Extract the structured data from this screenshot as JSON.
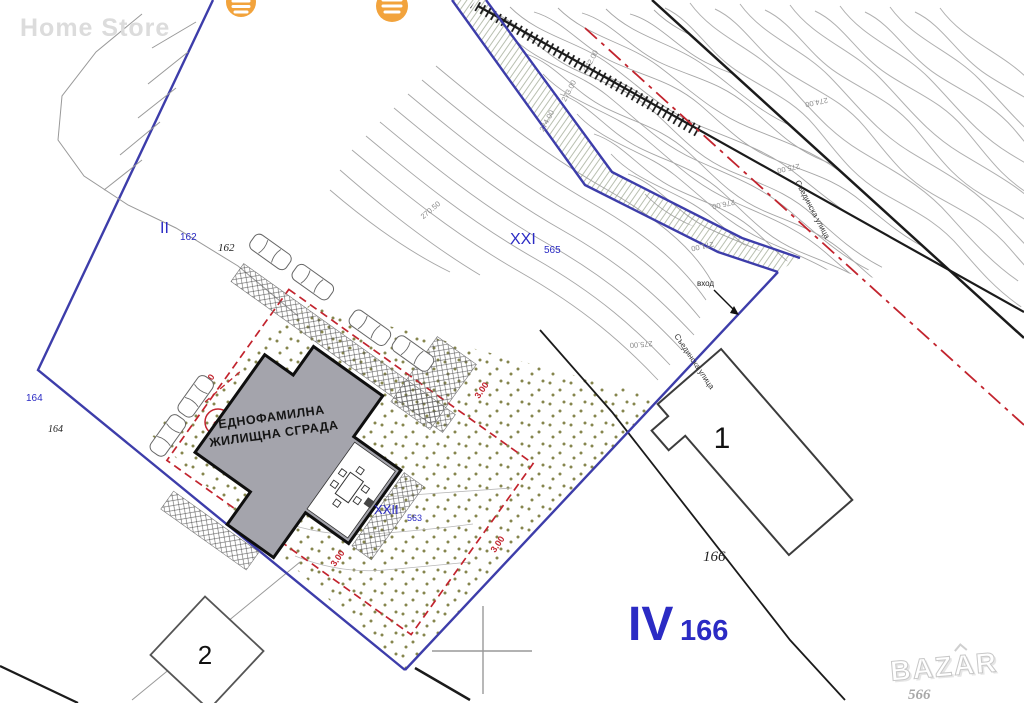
{
  "watermarks": {
    "home_store": "Home Store",
    "logo": "BAZAR",
    "logo_number": "566"
  },
  "parcels": {
    "II": {
      "roman": "II",
      "number": "162",
      "cadastre": "162"
    },
    "XXI": {
      "roman": "XXI",
      "number": "565"
    },
    "XXII": {
      "roman": "XXII",
      "number": "563"
    },
    "IV": {
      "roman": "IV",
      "number": "166",
      "cadastre": "166"
    },
    "left": {
      "blue": "164",
      "black": "164"
    }
  },
  "building": {
    "label_line1": "ЕДНОФАМИЛНА",
    "label_line2": "ЖИЛИЩНА СГРАДА",
    "number_circle": "38"
  },
  "neighbor_buildings": {
    "b1": "1",
    "b2": "2"
  },
  "annotations": {
    "entrance": "вход",
    "street": "Съединска улица",
    "setback": "3.00"
  },
  "elevations": [
    "272.00",
    "273.00",
    "274.00",
    "274.00",
    "275.00",
    "276.00",
    "271.00",
    "275.00",
    "270.50"
  ]
}
